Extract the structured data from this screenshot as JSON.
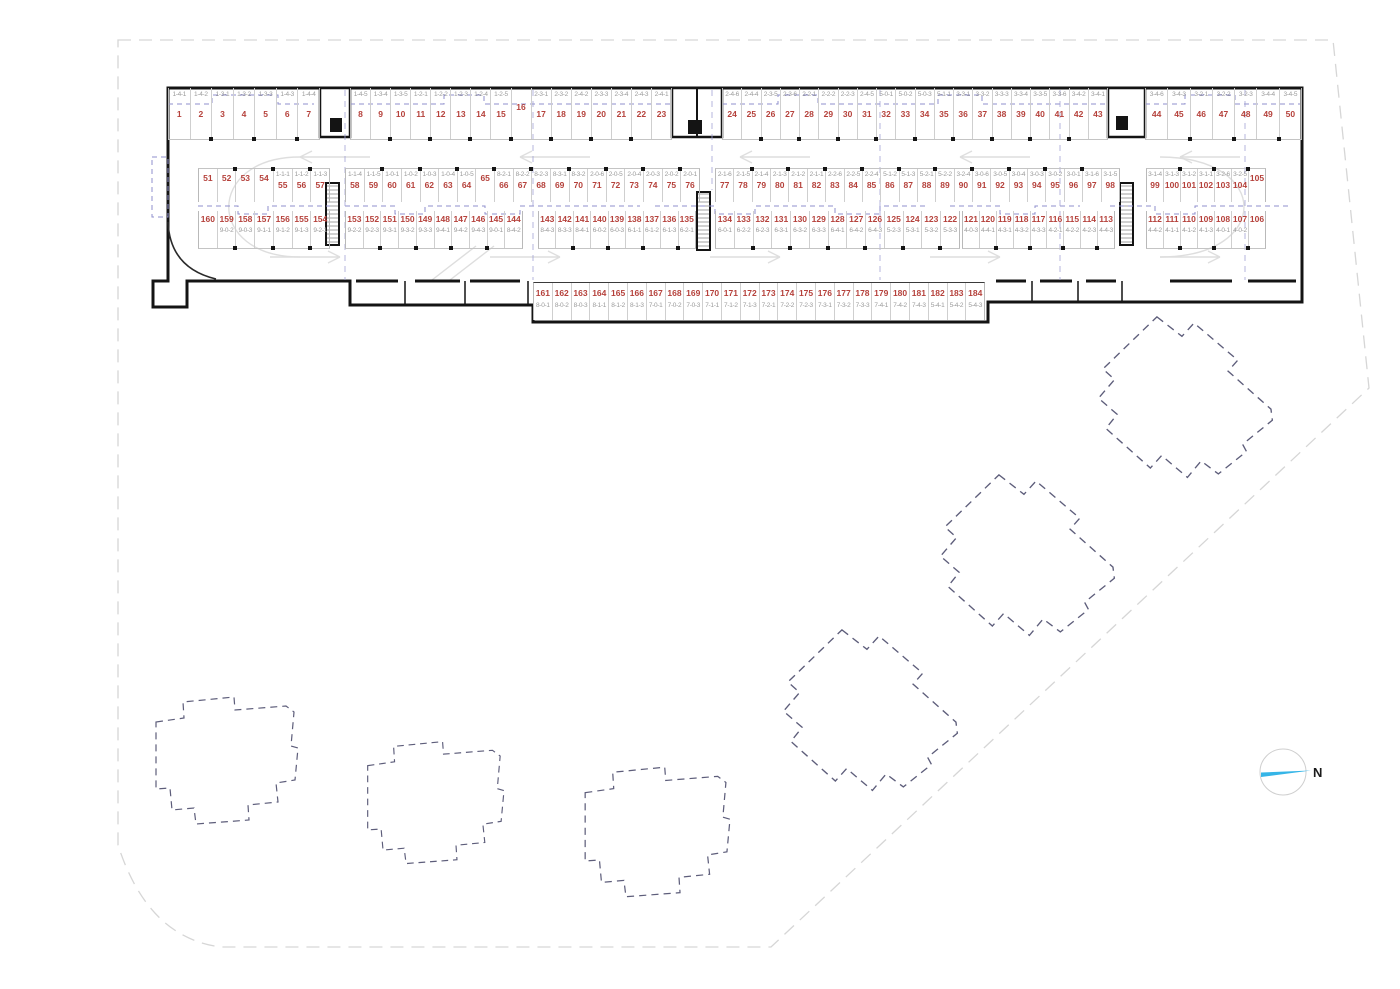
{
  "north": {
    "label": "N"
  },
  "colors": {
    "space_number": "#b5413b",
    "unit_label": "#9b9b9b",
    "wall": "#141414",
    "overlay_blue": "#8f8fcc",
    "footprint_dash": "#5d5d7a",
    "boundary": "#d6d6d6",
    "north_needle": "#35b5e7"
  },
  "garage": {
    "rows": [
      {
        "id": "row-1",
        "label_position": "above",
        "segments": [
          [
            {
              "n": "1",
              "u": "1-4-1"
            },
            {
              "n": "2",
              "u": "1-4-2"
            },
            {
              "n": "3",
              "u": "1-3-1"
            },
            {
              "n": "4",
              "u": "1-3-2"
            },
            {
              "n": "5",
              "u": "1-3-3"
            },
            {
              "n": "6",
              "u": "1-4-3"
            },
            {
              "n": "7",
              "u": "1-4-4"
            }
          ],
          [
            {
              "n": "8",
              "u": "1-4-5"
            },
            {
              "n": "9",
              "u": "1-3-4"
            },
            {
              "n": "10",
              "u": "1-3-5"
            },
            {
              "n": "11",
              "u": "1-2-1"
            },
            {
              "n": "12",
              "u": "1-2-2"
            },
            {
              "n": "13",
              "u": "1-2-3"
            },
            {
              "n": "14",
              "u": "1-2-4"
            },
            {
              "n": "15",
              "u": "1-2-5"
            },
            {
              "n": "16",
              "u": ""
            },
            {
              "n": "17",
              "u": "2-3-1"
            },
            {
              "n": "18",
              "u": "2-3-2"
            },
            {
              "n": "19",
              "u": "2-4-2"
            },
            {
              "n": "20",
              "u": "2-3-3"
            },
            {
              "n": "21",
              "u": "2-3-4"
            },
            {
              "n": "22",
              "u": "2-4-3"
            },
            {
              "n": "23",
              "u": "2-4-1"
            }
          ],
          [
            {
              "n": "24",
              "u": "2-4-6"
            },
            {
              "n": "25",
              "u": "2-4-4"
            },
            {
              "n": "26",
              "u": "2-3-5"
            },
            {
              "n": "27",
              "u": "2-3-6"
            },
            {
              "n": "28",
              "u": "2-2-1"
            },
            {
              "n": "29",
              "u": "2-2-2"
            },
            {
              "n": "30",
              "u": "2-2-3"
            },
            {
              "n": "31",
              "u": "2-4-5"
            },
            {
              "n": "32",
              "u": "5-0-1"
            },
            {
              "n": "33",
              "u": "5-0-2"
            },
            {
              "n": "34",
              "u": "5-0-3"
            },
            {
              "n": "35",
              "u": "5-1-1"
            },
            {
              "n": "36",
              "u": "3-3-1"
            },
            {
              "n": "37",
              "u": "3-3-2"
            },
            {
              "n": "38",
              "u": "3-3-3"
            },
            {
              "n": "39",
              "u": "3-3-4"
            },
            {
              "n": "40",
              "u": "3-3-5"
            },
            {
              "n": "41",
              "u": "3-3-6"
            },
            {
              "n": "42",
              "u": "3-4-2"
            },
            {
              "n": "43",
              "u": "3-4-1"
            }
          ],
          [
            {
              "n": "44",
              "u": "3-4-6"
            },
            {
              "n": "45",
              "u": "3-4-3"
            },
            {
              "n": "46",
              "u": "3-2-1"
            },
            {
              "n": "47",
              "u": "3-2-2"
            },
            {
              "n": "48",
              "u": "3-2-3"
            },
            {
              "n": "49",
              "u": "3-4-4"
            },
            {
              "n": "50",
              "u": "3-4-5"
            }
          ]
        ]
      },
      {
        "id": "row-2",
        "label_position": "above",
        "segments": [
          [
            {
              "n": "51",
              "u": ""
            },
            {
              "n": "52",
              "u": ""
            },
            {
              "n": "53",
              "u": ""
            },
            {
              "n": "54",
              "u": ""
            },
            {
              "n": "55",
              "u": "1-1-1"
            },
            {
              "n": "56",
              "u": "1-1-2"
            },
            {
              "n": "57",
              "u": "1-1-3"
            }
          ],
          [
            {
              "n": "58",
              "u": "1-1-4"
            },
            {
              "n": "59",
              "u": "1-1-5"
            },
            {
              "n": "60",
              "u": "1-0-1"
            },
            {
              "n": "61",
              "u": "1-0-2"
            },
            {
              "n": "62",
              "u": "1-0-3"
            },
            {
              "n": "63",
              "u": "1-0-4"
            },
            {
              "n": "64",
              "u": "1-0-5"
            },
            {
              "n": "65",
              "u": ""
            },
            {
              "n": "66",
              "u": "8-2-1"
            },
            {
              "n": "67",
              "u": "8-2-2"
            },
            {
              "n": "68",
              "u": "8-2-3"
            },
            {
              "n": "69",
              "u": "8-3-1"
            },
            {
              "n": "70",
              "u": "8-3-2"
            },
            {
              "n": "71",
              "u": "2-0-6"
            },
            {
              "n": "72",
              "u": "2-0-5"
            },
            {
              "n": "73",
              "u": "2-0-4"
            },
            {
              "n": "74",
              "u": "2-0-3"
            },
            {
              "n": "75",
              "u": "2-0-2"
            },
            {
              "n": "76",
              "u": "2-0-1"
            }
          ],
          [
            {
              "n": "77",
              "u": "2-1-6"
            },
            {
              "n": "78",
              "u": "2-1-5"
            },
            {
              "n": "79",
              "u": "2-1-4"
            },
            {
              "n": "80",
              "u": "2-1-3"
            },
            {
              "n": "81",
              "u": "2-1-2"
            },
            {
              "n": "82",
              "u": "2-1-1"
            },
            {
              "n": "83",
              "u": "2-2-6"
            },
            {
              "n": "84",
              "u": "2-2-5"
            },
            {
              "n": "85",
              "u": "2-2-4"
            },
            {
              "n": "86",
              "u": "5-1-2"
            },
            {
              "n": "87",
              "u": "5-1-3"
            },
            {
              "n": "88",
              "u": "5-2-1"
            },
            {
              "n": "89",
              "u": "5-2-2"
            },
            {
              "n": "90",
              "u": "3-2-4"
            },
            {
              "n": "91",
              "u": "3-0-6"
            },
            {
              "n": "92",
              "u": "3-0-5"
            },
            {
              "n": "93",
              "u": "3-0-4"
            },
            {
              "n": "94",
              "u": "3-0-3"
            },
            {
              "n": "95",
              "u": "3-0-2"
            },
            {
              "n": "96",
              "u": "3-0-1"
            },
            {
              "n": "97",
              "u": "3-1-6"
            },
            {
              "n": "98",
              "u": "3-1-5"
            }
          ],
          [
            {
              "n": "99",
              "u": "3-1-4"
            },
            {
              "n": "100",
              "u": "3-1-3"
            },
            {
              "n": "101",
              "u": "3-1-2"
            },
            {
              "n": "102",
              "u": "3-1-1"
            },
            {
              "n": "103",
              "u": "3-2-6"
            },
            {
              "n": "104",
              "u": "3-2-5"
            },
            {
              "n": "105",
              "u": ""
            }
          ]
        ]
      },
      {
        "id": "row-3",
        "label_position": "below",
        "segments": [
          [
            {
              "n": "160",
              "u": ""
            },
            {
              "n": "159",
              "u": "9-0-2"
            },
            {
              "n": "158",
              "u": "9-0-3"
            },
            {
              "n": "157",
              "u": "9-1-1"
            },
            {
              "n": "156",
              "u": "9-1-2"
            },
            {
              "n": "155",
              "u": "9-1-3"
            },
            {
              "n": "154",
              "u": "9-2-1"
            }
          ],
          [
            {
              "n": "153",
              "u": "9-2-2"
            },
            {
              "n": "152",
              "u": "9-2-3"
            },
            {
              "n": "151",
              "u": "9-3-1"
            },
            {
              "n": "150",
              "u": "9-3-2"
            },
            {
              "n": "149",
              "u": "9-3-3"
            },
            {
              "n": "148",
              "u": "9-4-1"
            },
            {
              "n": "147",
              "u": "9-4-2"
            },
            {
              "n": "146",
              "u": "9-4-3"
            },
            {
              "n": "145",
              "u": "9-0-1"
            },
            {
              "n": "144",
              "u": "8-4-2"
            }
          ],
          [
            {
              "n": "143",
              "u": "8-4-3"
            },
            {
              "n": "142",
              "u": "8-3-3"
            },
            {
              "n": "141",
              "u": "8-4-1"
            },
            {
              "n": "140",
              "u": "6-0-2"
            },
            {
              "n": "139",
              "u": "6-0-3"
            },
            {
              "n": "138",
              "u": "6-1-1"
            },
            {
              "n": "137",
              "u": "6-1-2"
            },
            {
              "n": "136",
              "u": "6-1-3"
            },
            {
              "n": "135",
              "u": "6-2-1"
            }
          ],
          [
            {
              "n": "134",
              "u": "6-0-1"
            },
            {
              "n": "133",
              "u": "6-2-2"
            },
            {
              "n": "132",
              "u": "6-2-3"
            },
            {
              "n": "131",
              "u": "6-3-1"
            },
            {
              "n": "130",
              "u": "6-3-2"
            },
            {
              "n": "129",
              "u": "6-3-3"
            },
            {
              "n": "128",
              "u": "6-4-1"
            },
            {
              "n": "127",
              "u": "6-4-2"
            },
            {
              "n": "126",
              "u": "6-4-3"
            },
            {
              "n": "125",
              "u": "5-2-3"
            },
            {
              "n": "124",
              "u": "5-3-1"
            },
            {
              "n": "123",
              "u": "5-3-2"
            },
            {
              "n": "122",
              "u": "5-3-3"
            }
          ],
          [
            {
              "n": "121",
              "u": "4-0-3"
            },
            {
              "n": "120",
              "u": "4-4-1"
            },
            {
              "n": "119",
              "u": "4-3-1"
            },
            {
              "n": "118",
              "u": "4-3-2"
            },
            {
              "n": "117",
              "u": "4-3-3"
            },
            {
              "n": "116",
              "u": "4-2-1"
            },
            {
              "n": "115",
              "u": "4-2-2"
            },
            {
              "n": "114",
              "u": "4-2-3"
            },
            {
              "n": "113",
              "u": "4-4-3"
            }
          ],
          [
            {
              "n": "112",
              "u": "4-4-2"
            },
            {
              "n": "111",
              "u": "4-1-1"
            },
            {
              "n": "110",
              "u": "4-1-2"
            },
            {
              "n": "109",
              "u": "4-1-3"
            },
            {
              "n": "108",
              "u": "4-0-1"
            },
            {
              "n": "107",
              "u": "4-0-2"
            },
            {
              "n": "106",
              "u": ""
            }
          ]
        ]
      },
      {
        "id": "row-4",
        "label_position": "below",
        "segments": [
          [
            {
              "n": "161",
              "u": "8-0-1"
            },
            {
              "n": "162",
              "u": "8-0-2"
            },
            {
              "n": "163",
              "u": "8-0-3"
            },
            {
              "n": "164",
              "u": "8-1-1"
            },
            {
              "n": "165",
              "u": "8-1-2"
            },
            {
              "n": "166",
              "u": "8-1-3"
            },
            {
              "n": "167",
              "u": "7-0-1"
            },
            {
              "n": "168",
              "u": "7-0-2"
            },
            {
              "n": "169",
              "u": "7-0-3"
            },
            {
              "n": "170",
              "u": "7-1-1"
            },
            {
              "n": "171",
              "u": "7-1-2"
            },
            {
              "n": "172",
              "u": "7-1-3"
            },
            {
              "n": "173",
              "u": "7-2-1"
            },
            {
              "n": "174",
              "u": "7-2-2"
            },
            {
              "n": "175",
              "u": "7-2-3"
            },
            {
              "n": "176",
              "u": "7-3-1"
            },
            {
              "n": "177",
              "u": "7-3-2"
            },
            {
              "n": "178",
              "u": "7-3-3"
            },
            {
              "n": "179",
              "u": "7-4-1"
            },
            {
              "n": "180",
              "u": "7-4-2"
            },
            {
              "n": "181",
              "u": "7-4-3"
            },
            {
              "n": "182",
              "u": "5-4-1"
            },
            {
              "n": "183",
              "u": "5-4-2"
            },
            {
              "n": "184",
              "u": "5-4-3"
            }
          ]
        ]
      }
    ]
  }
}
